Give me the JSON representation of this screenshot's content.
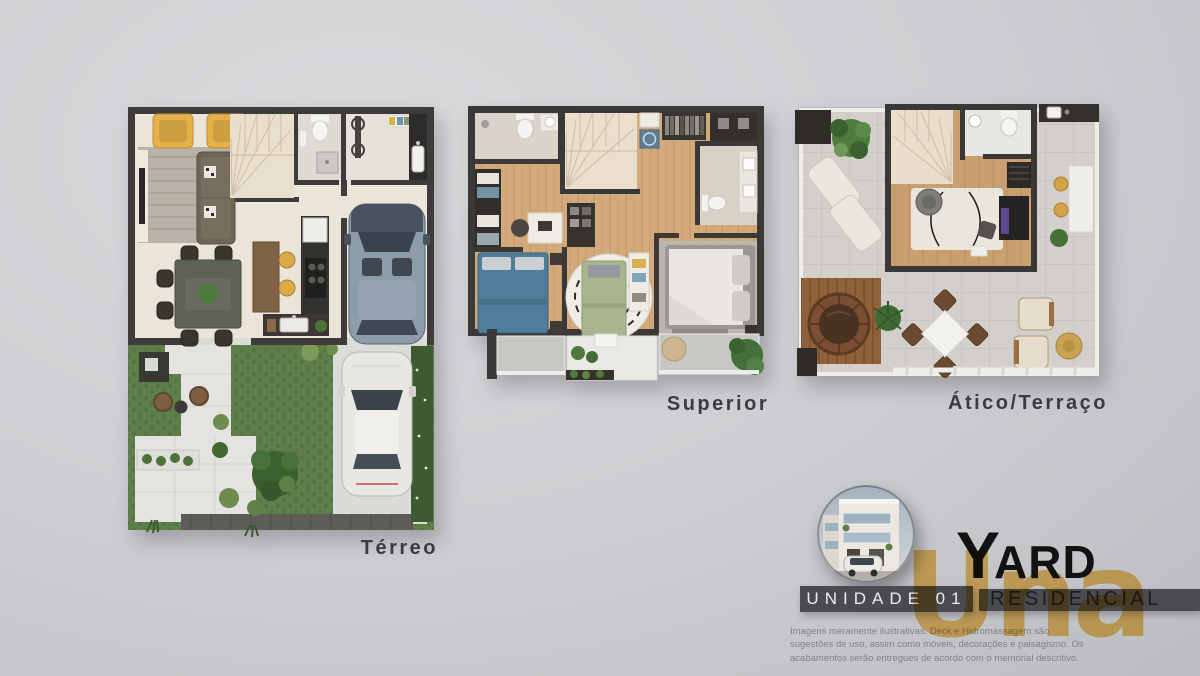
{
  "floor_plans": [
    {
      "id": "terreo",
      "label": "Térreo"
    },
    {
      "id": "superior",
      "label": "Superior"
    },
    {
      "id": "atico",
      "label": "Ático/Terraço"
    }
  ],
  "branding": {
    "unit_label": "UNIDADE 01",
    "logo_initial": "Y",
    "logo_rest": "ARD",
    "logo_subtitle": "RESIDENCIAL",
    "watermark": "Una",
    "colors": {
      "banner_gray": "#4a4b4f",
      "logo_black": "#121212",
      "watermark_gold": "#c99f4e",
      "label_text": "#3a3c40",
      "background": "#cdced1"
    }
  },
  "disclaimer": {
    "text": "Imagens meramente ilustrativas. Deck e Hidromassagem são sugestões de uso, assim como móveis, decorações e paisagismo. Os acabamentos serão entregues de acordo com o memorial descritivo."
  }
}
